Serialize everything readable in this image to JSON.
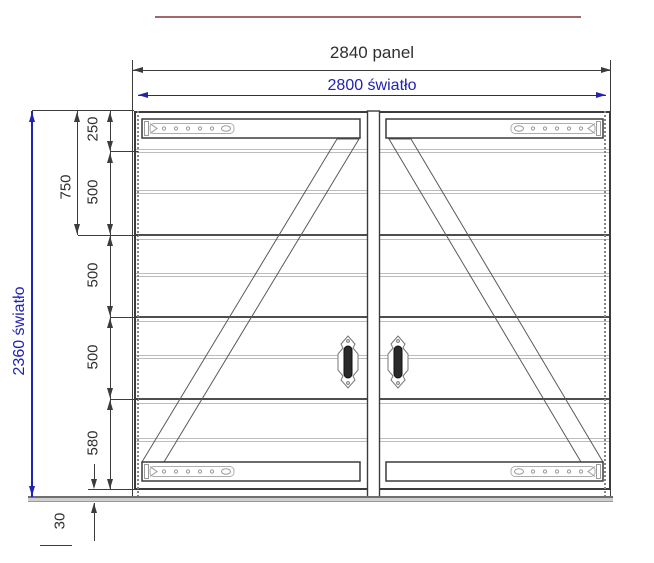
{
  "drawing": {
    "type": "technical-gate-drawing",
    "description": "Double-leaf garage gate front elevation with dimensions",
    "dims": {
      "panel_width_label": "2840 panel",
      "clear_width_label": "2800 światło",
      "clear_height_label": "2360 światło",
      "left_sub_label": "750",
      "chain_labels": [
        "250",
        "500",
        "500",
        "500",
        "580"
      ],
      "bottom_gap_label": "30"
    },
    "colors": {
      "dimension_blue": "#2121b4",
      "drawing_dark": "#3c3c3c",
      "seam_light": "#bcbcbc",
      "seam_dark": "#4e4e4e",
      "ground_gray": "#cfcfcf",
      "accent_brown": "#a06a6a",
      "handle_dark": "#2a2a2a",
      "hinge_gray": "#9a9a9a"
    },
    "icons": {
      "hinge_strap": "strap-hinge-with-screw-holes",
      "handle": "gate-pull-handle-escutcheon"
    }
  }
}
